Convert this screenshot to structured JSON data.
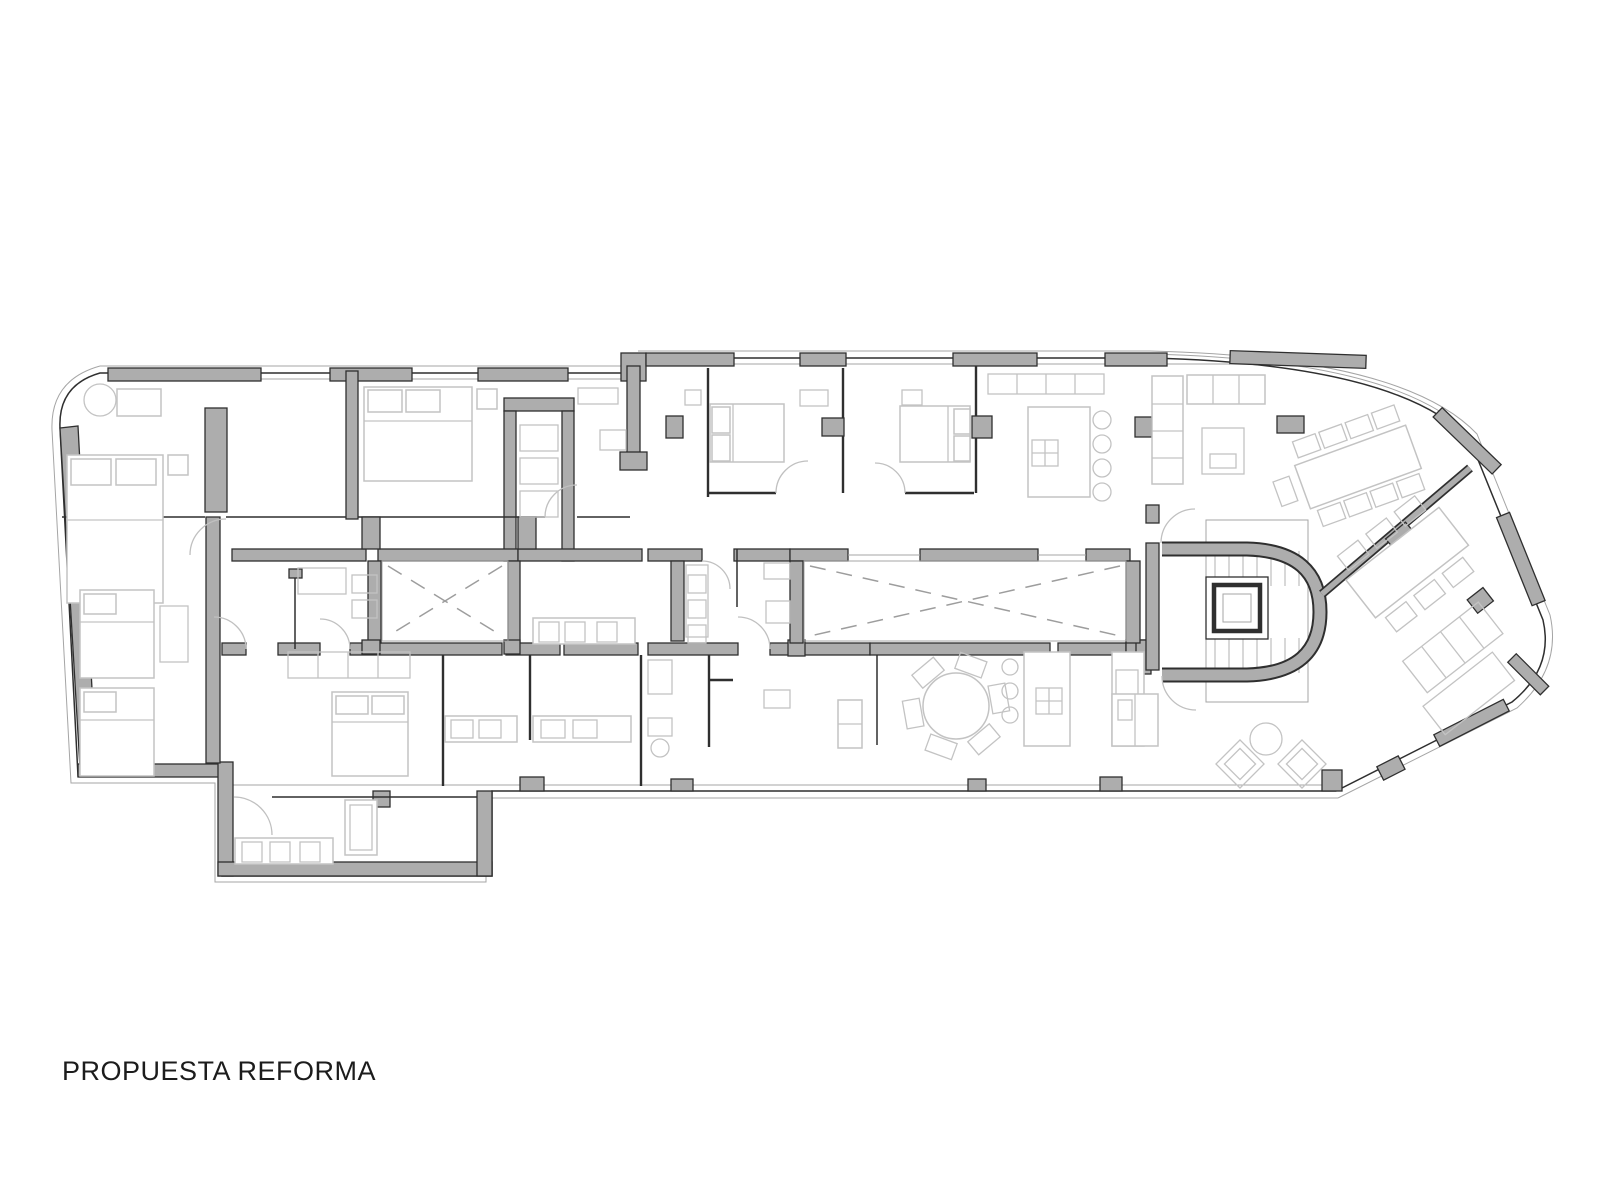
{
  "title": {
    "text": "PROPUESTA REFORMA"
  },
  "canvas": {
    "width": 1600,
    "height": 1200,
    "background": "#ffffff"
  },
  "colors": {
    "wall_fill": "#adadad",
    "wall_stroke": "#2f2f2f",
    "line_dark": "#2f2f2f",
    "furniture_line": "#c3c3c3",
    "glazing_line": "#a5a5a5",
    "dash_line": "#9d9d9d",
    "title_color": "#1c1c1c"
  }
}
